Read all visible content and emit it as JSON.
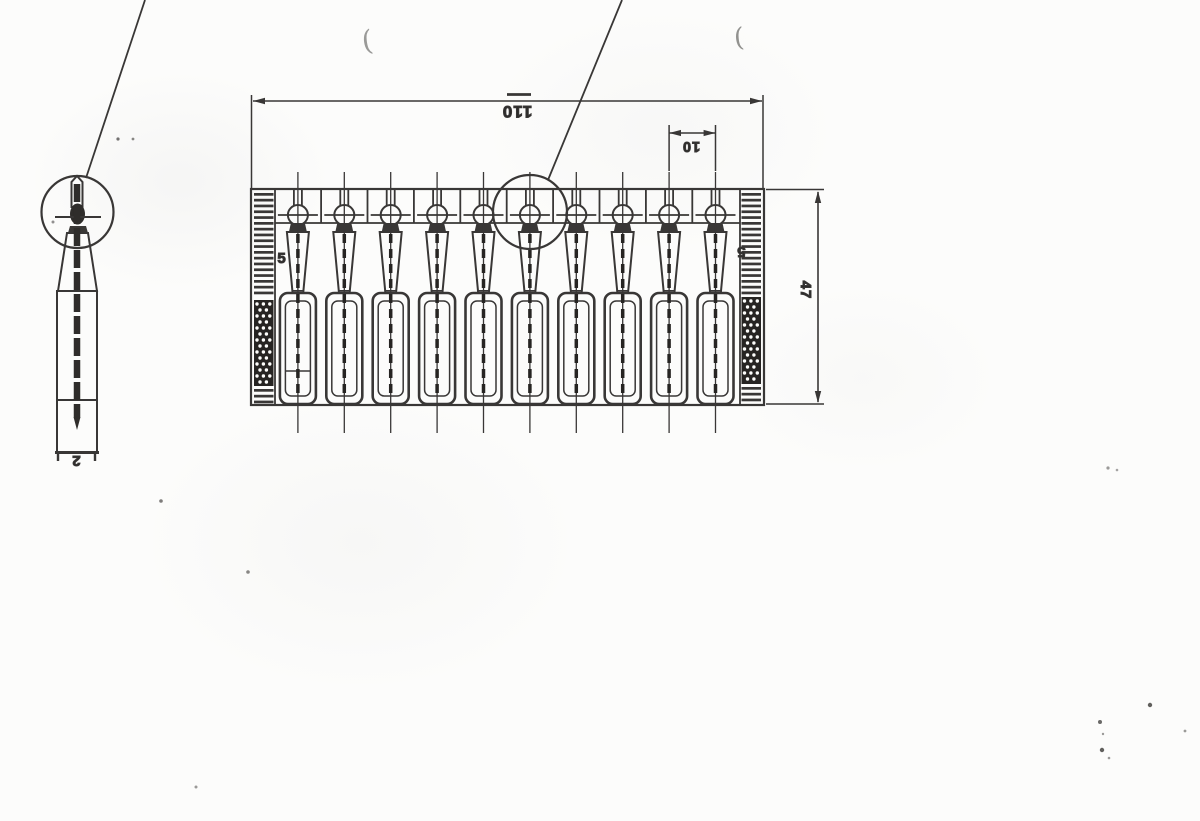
{
  "drawing": {
    "kind": "scanned engineering drawing of a 10-pin stamped contact strip",
    "style": {
      "paper_color": "#fcfcfb",
      "ink_color": "#393736",
      "dark_fill": "#262422",
      "speck_color": "#fdfdfb"
    },
    "front_view": {
      "pin_count": 10,
      "dimensions": {
        "overall_width": "110",
        "pin_pitch": "10",
        "overall_height": "47",
        "edge_band_left": "5",
        "edge_band_right": "5"
      }
    },
    "side_view": {
      "dimensions": {
        "thickness": "2"
      }
    }
  }
}
